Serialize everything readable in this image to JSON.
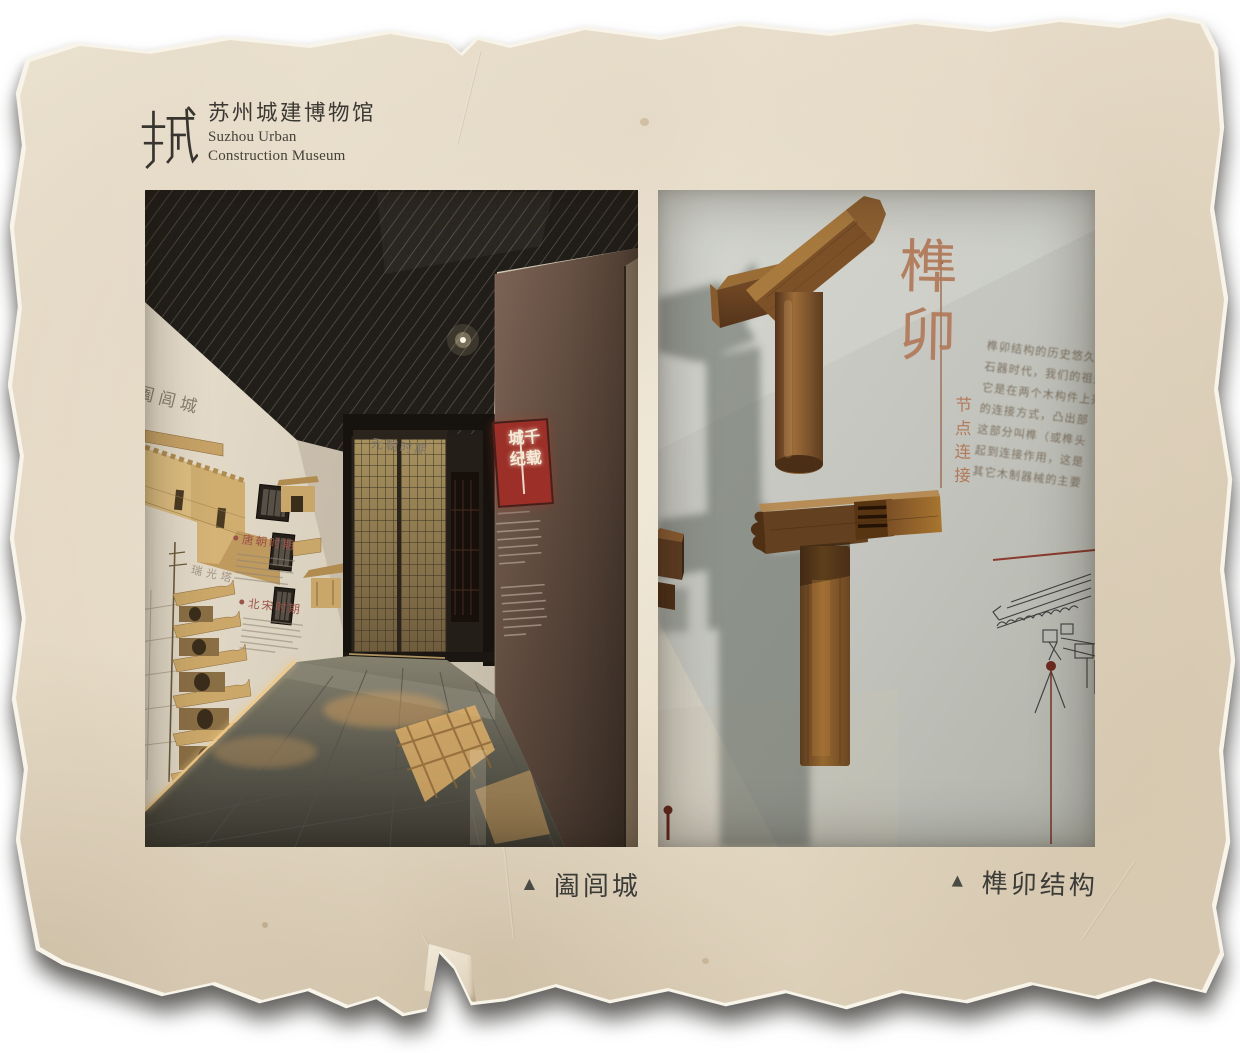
{
  "logo": {
    "glyph": "城",
    "name_cn": "苏州城建博物馆",
    "name_en_line1": "Suzhou Urban",
    "name_en_line2": "Construction Museum"
  },
  "captions": {
    "marker": "▲",
    "left": "阖闾城",
    "right": "榫卯结构"
  },
  "left_photo": {
    "wall_label_city": "阖闾城",
    "wall_label_yuan": "元朝时期",
    "wall_label_tang": "唐朝时期",
    "wall_label_song": "北宋时期",
    "wall_label_pagoda": "瑞光塔",
    "sign": {
      "column_right": "千载",
      "column_left": "城纪"
    }
  },
  "right_photo": {
    "title_vertical": "榫卯",
    "subtitle_vertical": "节点连接",
    "paragraph_lines": [
      "榫卯结构的历史悠久，早",
      "石器时代，我们的祖先",
      "它是在两个木构件上采",
      "的连接方式，凸出部",
      "这部分叫榫（或榫头",
      "起到连接作用，这是",
      "其它木制器械的主要"
    ]
  },
  "colors": {
    "paper": "#e8ddc9",
    "accent_red": "#9c2f27",
    "title_brown": "#b2795a",
    "ink": "#3b3b37"
  }
}
